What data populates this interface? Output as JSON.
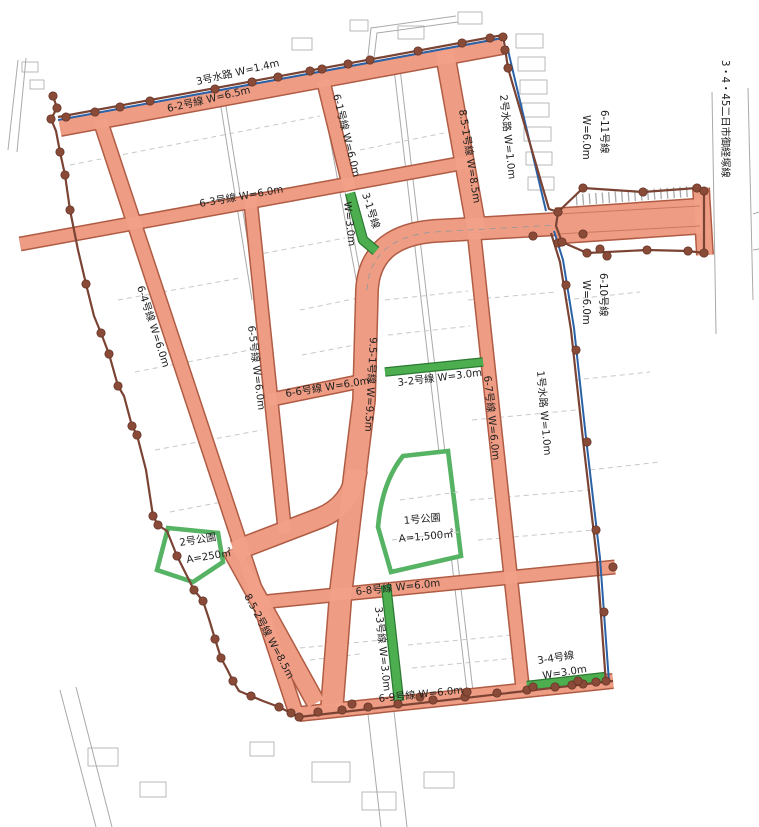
{
  "colors": {
    "road_fill": "#f2a189",
    "road_edge": "#b05c44",
    "green_road_fill": "#4cae4f",
    "green_road_edge": "#2c7a33",
    "park_outline": "#57b364",
    "water_line": "#2a62a8",
    "boundary": "#7b4334",
    "boundary_dot": "#8a4a38",
    "label_text": "#1e1e1e"
  },
  "waterways": {
    "w1": {
      "label": "1号水路 W=1.0m"
    },
    "w2": {
      "label": "2号水路 W=1.0m"
    },
    "w3": {
      "label": "3号水路 W=1.4m"
    }
  },
  "roads": {
    "r61": {
      "label": "6-1号線 W=6.0m"
    },
    "r62": {
      "label": "6-2号線 W=6.5m"
    },
    "r63": {
      "label": "6-3号線 W=6.0m"
    },
    "r64": {
      "label": "6-4号線 W=6.0m"
    },
    "r65": {
      "label": "6-5号線 W=6.0m"
    },
    "r66": {
      "label": "6-6号線 W=6.0m"
    },
    "r67": {
      "label": "6-7号線 W=6.0m"
    },
    "r68": {
      "label": "6-8号線 W=6.0m"
    },
    "r69": {
      "label": "6-9号線 W=6.0m"
    },
    "r610": {
      "name": "6-10号線",
      "width": "W=6.0m"
    },
    "r611": {
      "name": "6-11号線",
      "width": "W=6.0m"
    },
    "r851": {
      "label": "8.5-1号線 W=8.5m"
    },
    "r852": {
      "label": "8.5-2号線 W=8.5m"
    },
    "r951": {
      "label": "9.5-1号線 W=9.5m"
    },
    "r31": {
      "name": "3-1号線",
      "width": "W=3.0m"
    },
    "r32": {
      "label": "3-2号線 W=3.0m"
    },
    "r33": {
      "label": "3-3号線 W=3.0m"
    },
    "r34": {
      "name": "3-4号線",
      "width": "W=3.0m"
    }
  },
  "parks": {
    "p1": {
      "name": "1号公園",
      "area": "A=1,500㎡"
    },
    "p2": {
      "name": "2号公園",
      "area": "A=250㎡"
    }
  },
  "arterial_road": {
    "label": "3・4・45二日市御経塚線"
  }
}
